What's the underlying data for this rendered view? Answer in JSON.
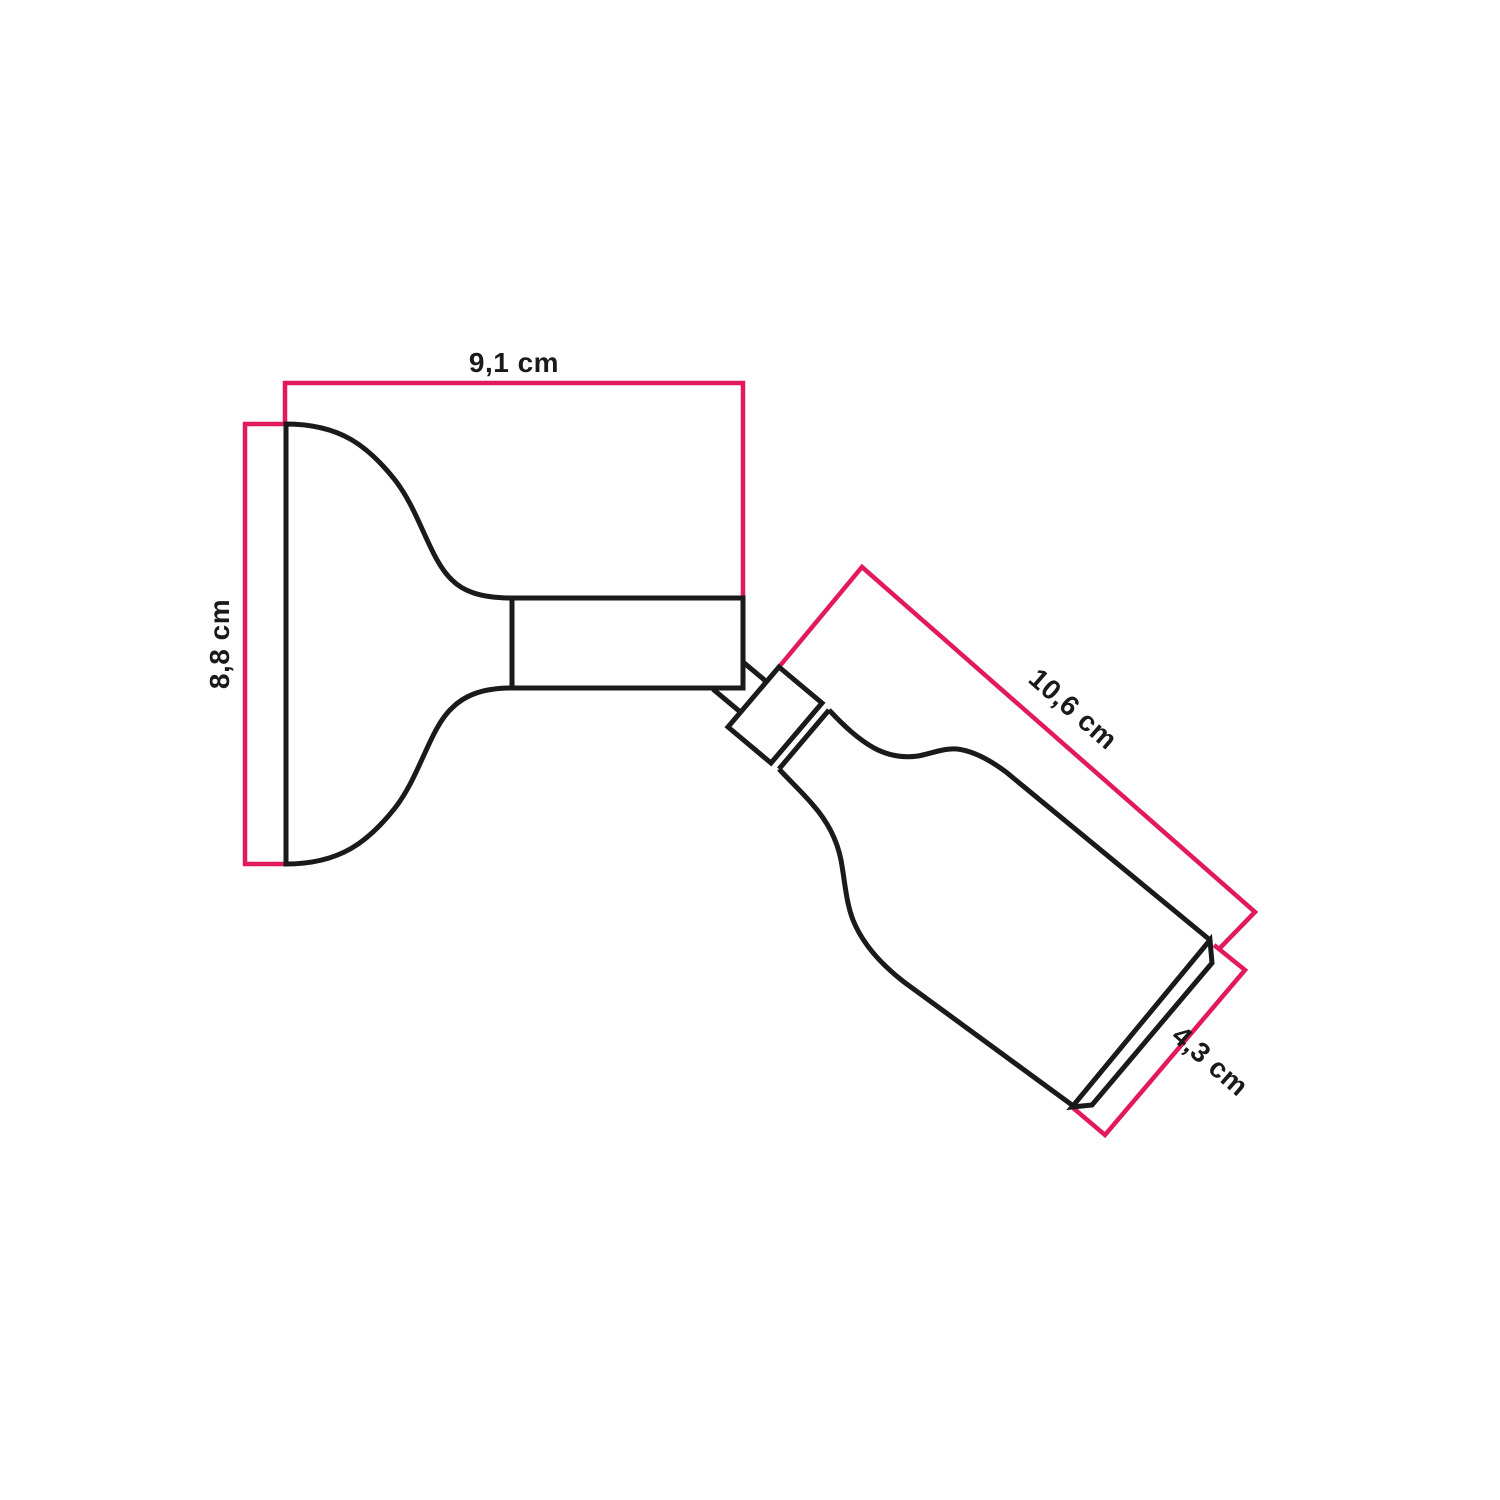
{
  "diagram": {
    "kind": "technical dimension drawing",
    "subject": "wall spotlight with pivoting lamp holder",
    "units": "cm",
    "colors": {
      "outline": "#1a1a1a",
      "dimension_lines": "#e3195e",
      "label_text": "#1a1a1a",
      "background": "#ffffff"
    },
    "dimensions": {
      "base_width": {
        "label": "9,1 cm",
        "value": 9.1
      },
      "base_height": {
        "label": "8,8 cm",
        "value": 8.8
      },
      "holder_length": {
        "label": "10,6 cm",
        "value": 10.6
      },
      "holder_diameter": {
        "label": "4,3 cm",
        "value": 4.3
      }
    }
  }
}
